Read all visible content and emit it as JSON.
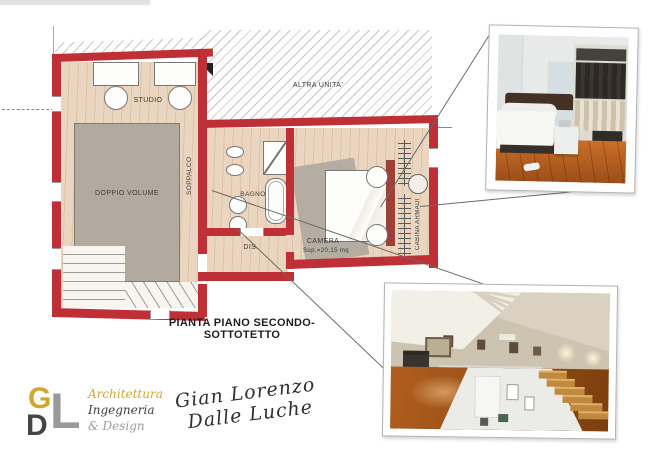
{
  "document": {
    "title": "PIANTA PIANO SECONDO-SOTTOTETTO"
  },
  "plan": {
    "labels": {
      "studio": "STUDIO",
      "altra_unita": "ALTRA UNITA'",
      "doppio_volume": "DOPPIO VOLUME",
      "soppalco": "SOPPALCO",
      "bagno": "BAGNO",
      "dis": "DIS.",
      "camera": "CAMERA",
      "camera_area": "Sup.=20,15 mq",
      "cabina_armadi": "CABINA ARMADI"
    },
    "colors": {
      "wall_red": "#bf2f36",
      "floor_wood": "#e9d5c0",
      "void_gray": "#b2aa9e",
      "hatch_line": "#c6c6c6"
    }
  },
  "logo": {
    "letter_g": "G",
    "letter_d": "D",
    "letter_l": "L",
    "field1": "Architettura",
    "field2": "Ingegneria",
    "field3": "& Design",
    "signature1": "Gian Lorenzo",
    "signature2": "Dalle Luche",
    "colors": {
      "gold": "#d2a62e",
      "gray": "#9a9a9a",
      "dark": "#3f3f3f",
      "ink": "#2e2e35"
    }
  }
}
